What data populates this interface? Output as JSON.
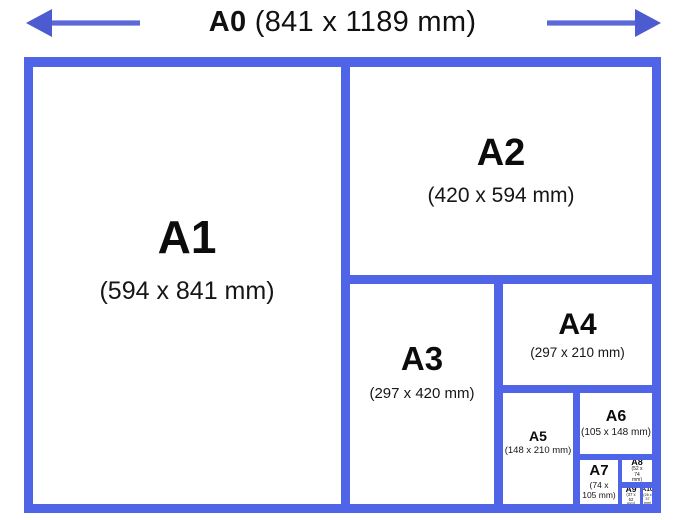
{
  "header": {
    "label": "A0",
    "dimensions": "(841 x 1189 mm)"
  },
  "colors": {
    "border_blue": "#4f64e6",
    "arrow_blue": "#5b68d8",
    "arrow_head_blue": "#4d5bd0",
    "text_black": "#111111",
    "background": "#ffffff"
  },
  "sizes": [
    {
      "id": "a1",
      "label": "A1",
      "dimensions": "(594 x 841 mm)"
    },
    {
      "id": "a2",
      "label": "A2",
      "dimensions": "(420 x 594 mm)"
    },
    {
      "id": "a3",
      "label": "A3",
      "dimensions": "(297 x 420 mm)"
    },
    {
      "id": "a4",
      "label": "A4",
      "dimensions": "(297 x 210 mm)"
    },
    {
      "id": "a5",
      "label": "A5",
      "dimensions": "(148 x 210 mm)"
    },
    {
      "id": "a6",
      "label": "A6",
      "dimensions": "(105 x 148 mm)"
    },
    {
      "id": "a7",
      "label": "A7",
      "dimensions": "(74 x 105 mm)"
    },
    {
      "id": "a8",
      "label": "A8",
      "dimensions": "(52 x 74 mm)"
    },
    {
      "id": "a9",
      "label": "A9",
      "dimensions": "(37 x 52 mm)"
    },
    {
      "id": "a10",
      "label": "A10",
      "dimensions": "(26 x 37 mm)"
    }
  ]
}
